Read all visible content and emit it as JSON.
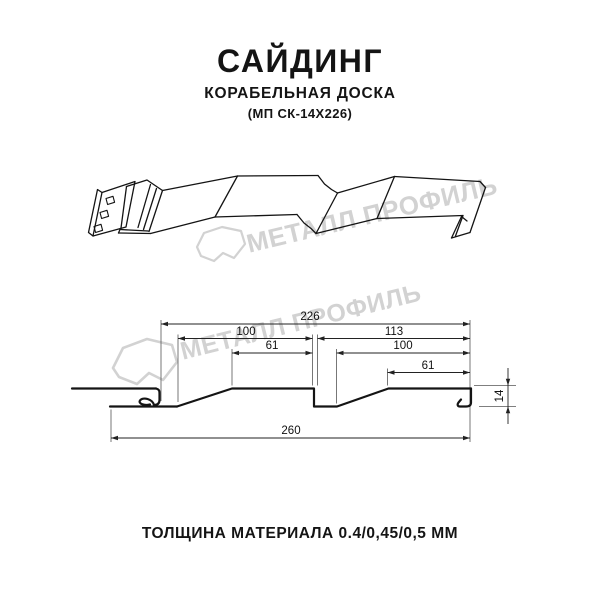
{
  "header": {
    "title": "САЙДИНГ",
    "subtitle": "КОРАБЕЛЬНАЯ ДОСКА",
    "product_code": "(МП СК-14Х226)"
  },
  "footer": {
    "text": "ТОЛЩИНА МАТЕРИАЛА 0.4/0,45/0,5 ММ"
  },
  "watermark": {
    "brand": "МЕТАЛЛ ПРОФИЛЬ",
    "color": "#d2d2d2"
  },
  "dimensions": {
    "dim226": "226",
    "dim100_left": "100",
    "dim113": "113",
    "dim61_left": "61",
    "dim100_right": "100",
    "dim61_right": "61",
    "dim260": "260",
    "dim14": "14"
  },
  "colors": {
    "background": "#ffffff",
    "line": "#141414",
    "dimension_line": "#222222",
    "watermark": "#d2d2d2"
  }
}
